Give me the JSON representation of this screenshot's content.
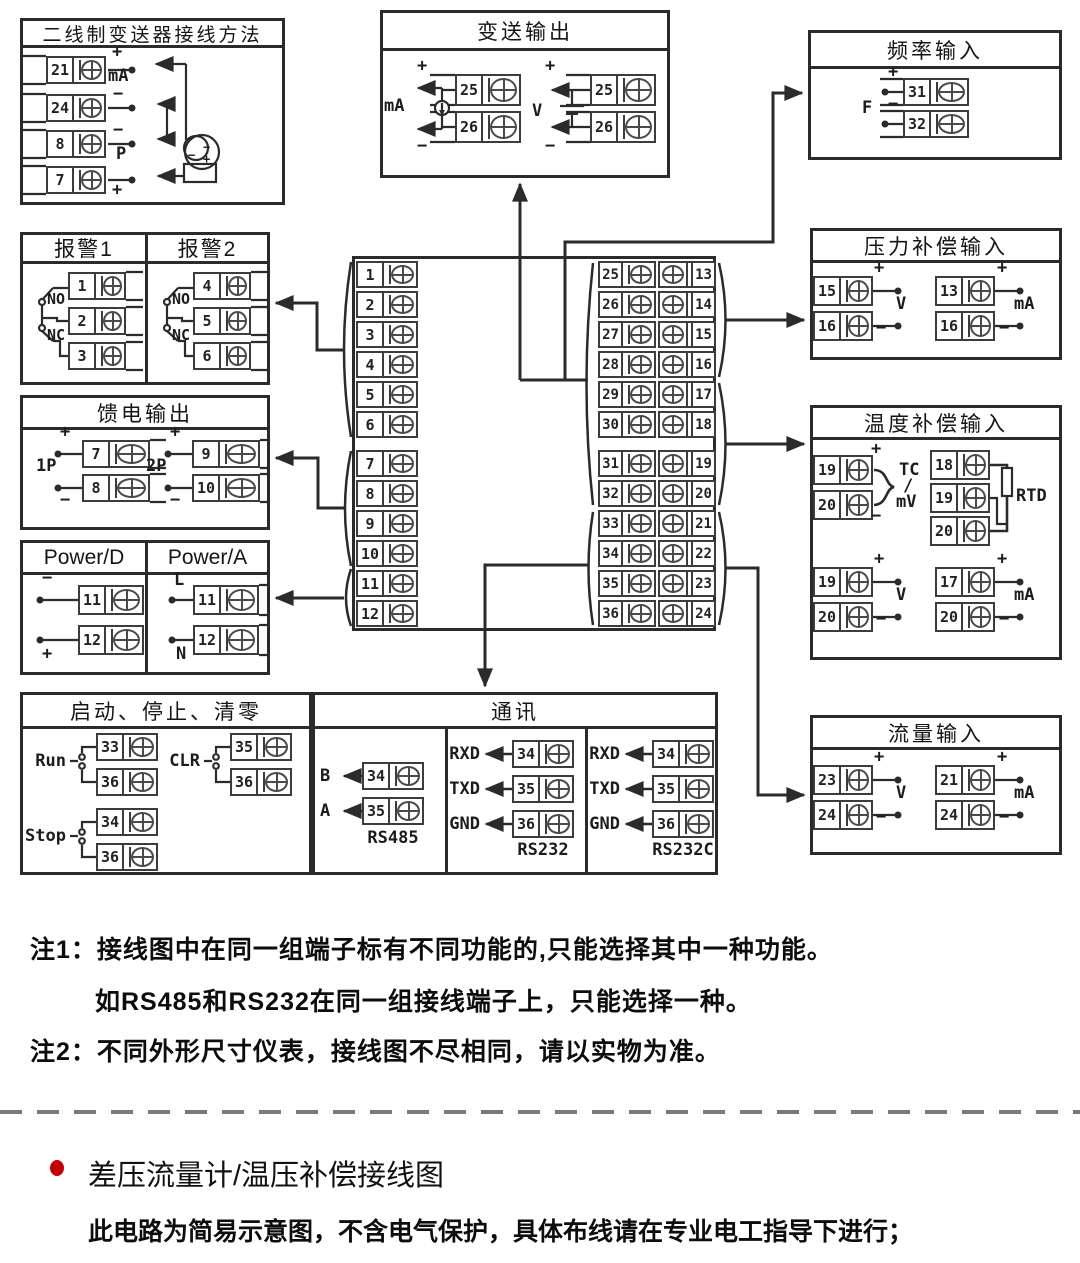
{
  "sym": {
    "plus": "+",
    "minus": "−",
    "ma": "mA",
    "v": "V",
    "p": "P",
    "f": "F",
    "no": "NO",
    "nc": "NC",
    "l": "L",
    "n": "N",
    "tc": "TC",
    "slash": "/",
    "mv": "mV",
    "rtd": "RTD",
    "p1": "1P",
    "p2": "2P",
    "run": "Run",
    "clr": "CLR",
    "stop": "Stop",
    "b": "B",
    "a": "A",
    "rxd": "RXD",
    "txd": "TXD",
    "gnd": "GND"
  },
  "boxes": {
    "two_wire": {
      "title": "二线制变送器接线方法",
      "t": [
        "21",
        "24",
        "8",
        "7"
      ]
    },
    "transmit": {
      "title": "变送输出",
      "ma": [
        "25",
        "26"
      ],
      "v": [
        "25",
        "26"
      ]
    },
    "freq": {
      "title": "频率输入",
      "t": [
        "31",
        "32"
      ]
    },
    "alarm": {
      "title1": "报警1",
      "title2": "报警2",
      "g1": [
        "1",
        "2",
        "3"
      ],
      "g2": [
        "4",
        "5",
        "6"
      ]
    },
    "feed": {
      "title": "馈电输出",
      "g1": [
        "7",
        "8"
      ],
      "g2": [
        "9",
        "10"
      ]
    },
    "power": {
      "title1": "Power/D",
      "title2": "Power/A",
      "d": [
        "11",
        "12"
      ],
      "a": [
        "11",
        "12"
      ]
    },
    "center": {
      "left": [
        "1",
        "2",
        "3",
        "4",
        "5",
        "6",
        "7",
        "8",
        "9",
        "10",
        "11",
        "12"
      ],
      "mid": [
        "25",
        "26",
        "27",
        "28",
        "29",
        "30",
        "31",
        "32",
        "33",
        "34",
        "35",
        "36"
      ],
      "right": [
        "13",
        "14",
        "15",
        "16",
        "17",
        "18",
        "19",
        "20",
        "21",
        "22",
        "23",
        "24"
      ]
    },
    "pressure": {
      "title": "压力补偿输入",
      "v": [
        "15",
        "16"
      ],
      "ma": [
        "13",
        "16"
      ]
    },
    "temp": {
      "title": "温度补偿输入",
      "tc": [
        "19",
        "20"
      ],
      "rtd": [
        "18",
        "19",
        "20"
      ],
      "v": [
        "19",
        "20"
      ],
      "ma": [
        "17",
        "20"
      ]
    },
    "flow": {
      "title": "流量输入",
      "v": [
        "23",
        "24"
      ],
      "ma": [
        "21",
        "24"
      ]
    },
    "startstop": {
      "title": "启动、停止、清零",
      "run": [
        "33",
        "36"
      ],
      "clr": [
        "35",
        "36"
      ],
      "stop": [
        "34",
        "36"
      ]
    },
    "comm": {
      "title": "通讯",
      "rs485": {
        "name": "RS485",
        "t": [
          "34",
          "35"
        ]
      },
      "rs232": {
        "name": "RS232",
        "t": [
          "34",
          "35",
          "36"
        ]
      },
      "rs232c": {
        "name": "RS232C",
        "t": [
          "34",
          "35",
          "36"
        ]
      }
    }
  },
  "notes": {
    "n1a": "注1：接线图中在同一组端子标有不同功能的,只能选择其中一种功能。",
    "n1b": "如RS485和RS232在同一组接线端子上，只能选择一种。",
    "n2": "注2：不同外形尺寸仪表，接线图不尽相同，请以实物为准。"
  },
  "footer": {
    "heading": "差压流量计/温压补偿接线图",
    "sub": "此电路为简易示意图，不含电气保护，具体布线请在专业电工指导下进行；"
  },
  "colors": {
    "line": "#2b2b2b",
    "screw": "#4a4a4a",
    "bullet": "#c40000",
    "dash": "#7a7a7a"
  }
}
